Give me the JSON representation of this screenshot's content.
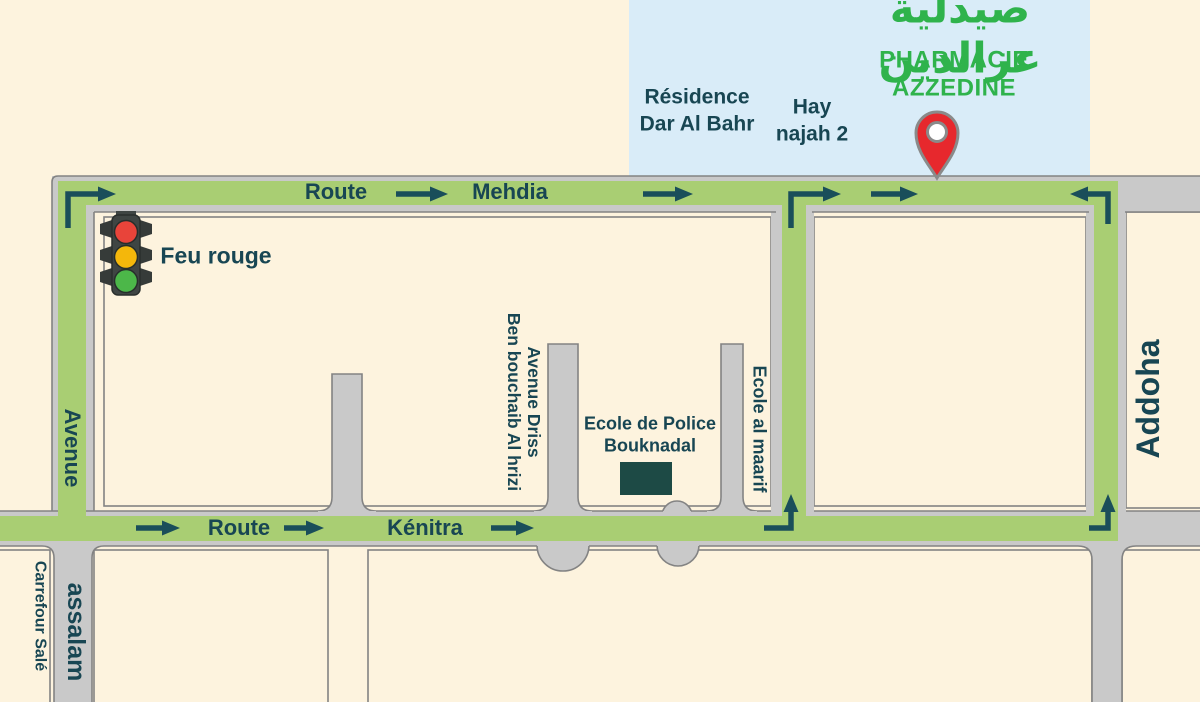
{
  "pharmacy": {
    "name_ar": "صيدلية عزالدين",
    "name_fr": "PHARMACIE AZZEDINE"
  },
  "areas": {
    "residence": "Résidence\nDar Al Bahr",
    "hay_najah": "Hay\nnajah 2",
    "addoha": "Addoha",
    "carrefour_sale": "Carrefour Salé"
  },
  "roads": {
    "mehdia_word1": "Route",
    "mehdia_word2": "Mehdia",
    "kenitra_word1": "Route",
    "kenitra_word2": "Kénitra",
    "avenue": "Avenue",
    "assalam": "assalam",
    "avenue_driss": "Avenue Driss\nBen bouchaib Al hrizi",
    "ecole_al_maarif": "Ecole al maarif"
  },
  "landmarks": {
    "feu_rouge": "Feu rouge",
    "ecole_police": "Ecole de Police\nBouknadal"
  },
  "colors": {
    "background_cream": "#fdf3de",
    "sky_blue": "#d9ecf8",
    "route_green": "#a9ce73",
    "road_gray": "#c9c9c9",
    "road_edge_gray": "#838383",
    "text_dark_teal": "#184653",
    "arrow_teal": "#1a4e5a",
    "pharmacy_green": "#2fb34c",
    "pin_red": "#e7282d",
    "building_dark": "#1d4a45",
    "light_red": "#e8443a",
    "light_amber": "#f4b70b",
    "light_green": "#4cb749"
  }
}
